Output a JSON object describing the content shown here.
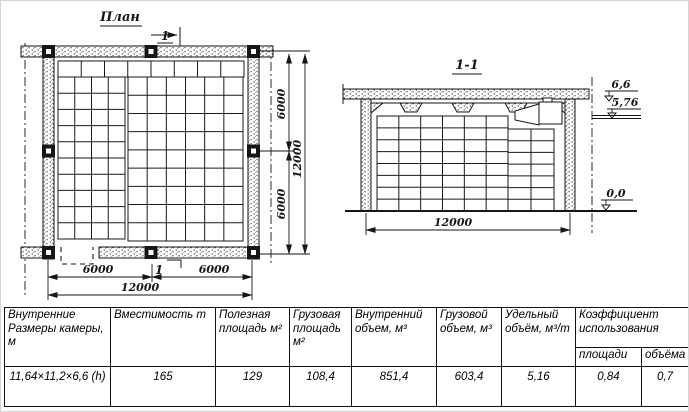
{
  "plan": {
    "title": "План",
    "cut_label_top": "1",
    "cut_label_bottom": "1",
    "dims": {
      "bottom_left": "6000",
      "bottom_right": "6000",
      "bottom_total": "12000",
      "right_upper": "6000",
      "right_lower": "6000",
      "right_total": "12000"
    }
  },
  "section": {
    "title": "1-1",
    "dims": {
      "width": "12000"
    },
    "elevations": {
      "ceiling": "6,6",
      "beam_bottom": "5,76",
      "floor": "0,0"
    }
  },
  "table": {
    "columns": [
      "Внутренние Размеры камеры, м",
      "Вместимость m",
      "Полезная площадь м²",
      "Грузовая площадь м²",
      "Внутренний объем, м³",
      "Грузовой объем, м³",
      "Удельный объём, м³/m",
      "Коэффициент использования"
    ],
    "subcolumns": [
      "площади",
      "объёма"
    ],
    "values": [
      "11,64×11,2×6,6 (h)",
      "165",
      "129",
      "108,4",
      "851,4",
      "603,4",
      "5,16",
      "0,84",
      "0,7"
    ]
  }
}
